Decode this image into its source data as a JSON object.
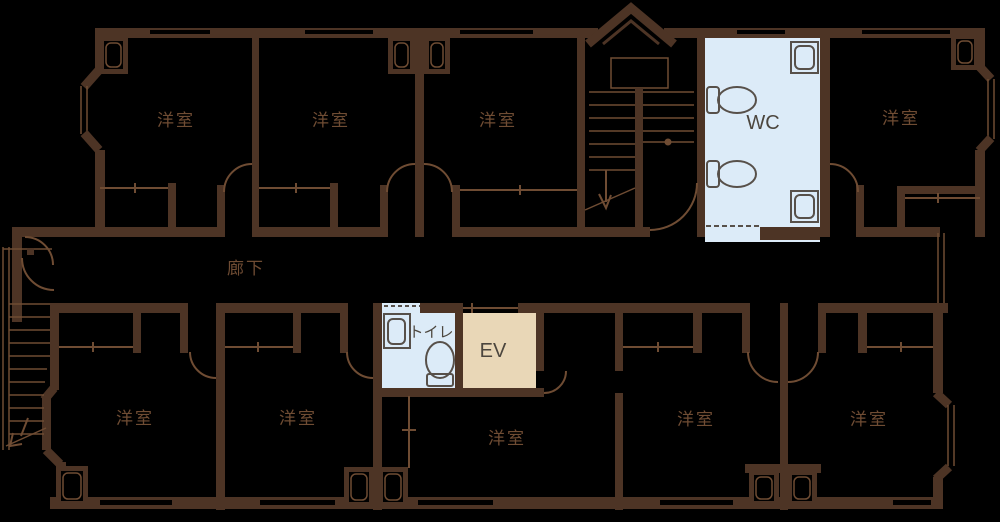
{
  "plan_title": "apartment-floor-plan",
  "labels": {
    "corridor": "廊下",
    "wc": "WC",
    "toilet": "トイレ",
    "elevator": "EV",
    "western_room": "洋室"
  },
  "rooms": [
    {
      "id": "room-top-1",
      "label": "洋室"
    },
    {
      "id": "room-top-2",
      "label": "洋室"
    },
    {
      "id": "room-top-3",
      "label": "洋室"
    },
    {
      "id": "room-top-4",
      "label": "洋室"
    },
    {
      "id": "room-bottom-1",
      "label": "洋室"
    },
    {
      "id": "room-bottom-2",
      "label": "洋室"
    },
    {
      "id": "room-bottom-center",
      "label": "洋室"
    },
    {
      "id": "room-bottom-3",
      "label": "洋室"
    },
    {
      "id": "room-bottom-4",
      "label": "洋室"
    },
    {
      "id": "wc",
      "label": "WC"
    },
    {
      "id": "toilet",
      "label": "トイレ"
    },
    {
      "id": "elevator",
      "label": "EV"
    },
    {
      "id": "corridor",
      "label": "廊下"
    }
  ],
  "colors": {
    "background": "#000000",
    "wall": "#4d3425",
    "thin_line": "#6f4c33",
    "wc_fill": "#dcebf8",
    "elevator_fill": "#e9d7b7",
    "fixture_line": "#57504a",
    "dark_text": "#4c463e"
  }
}
